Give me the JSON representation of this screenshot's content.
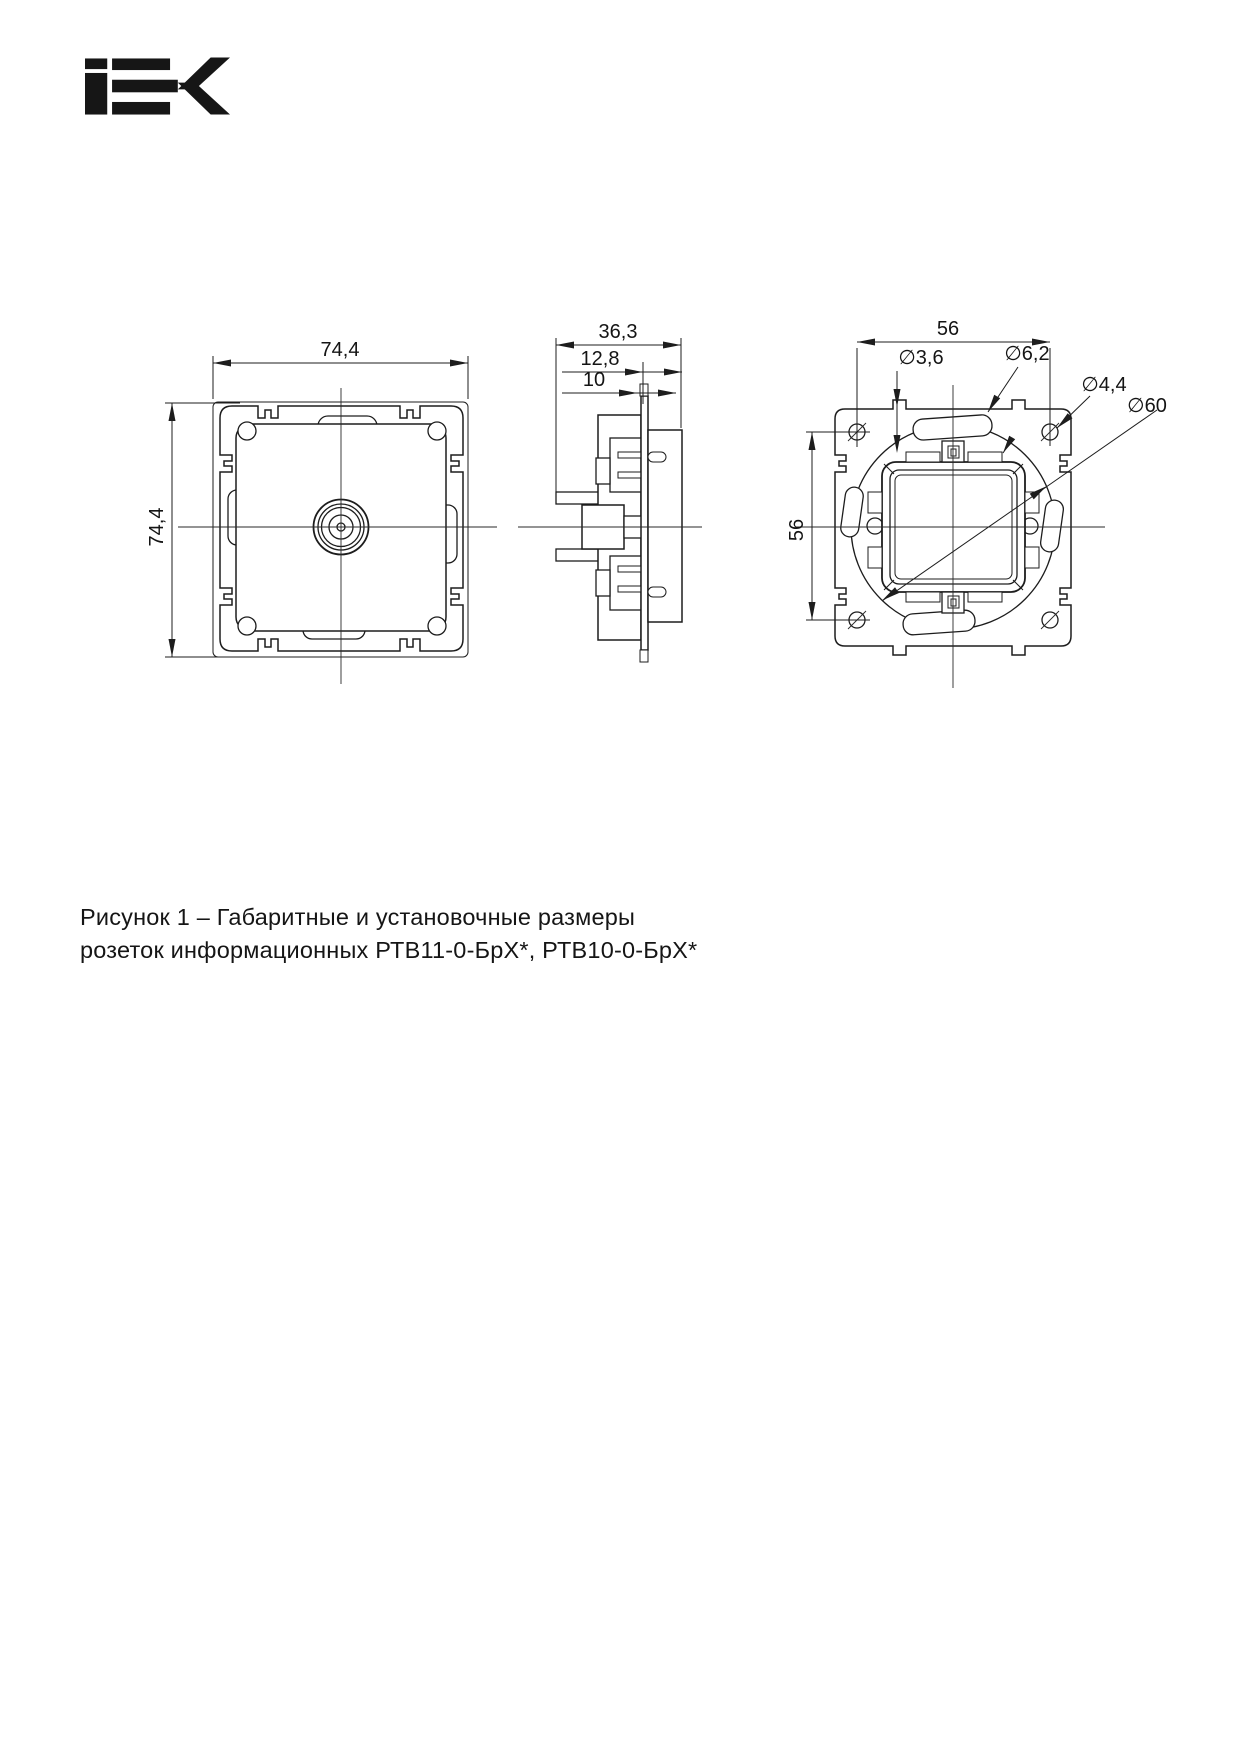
{
  "page": {
    "background": "#ffffff",
    "ink_color": "#1d1d1d"
  },
  "logo": {
    "brand": "IEK"
  },
  "caption": {
    "line1": "Рисунок 1 – Габаритные и установочные размеры",
    "line2": "розеток информационных РТВ11-0-БрХ*, РТВ10-0-БрХ*"
  },
  "drawings": {
    "front_view": {
      "dim_width": "74,4",
      "dim_height": "74,4"
    },
    "side_view": {
      "dim_total_depth": "36,3",
      "dim_front_depth": "12,8",
      "dim_plate_depth": "10"
    },
    "rear_view": {
      "dim_hole_spacing_h": "56",
      "dim_hole_spacing_v": "56",
      "dim_latch_hole": "∅3,6",
      "dim_claw_slot": "∅6,2",
      "dim_screw_hole": "∅4,4",
      "dim_mount_circle": "∅60"
    }
  }
}
